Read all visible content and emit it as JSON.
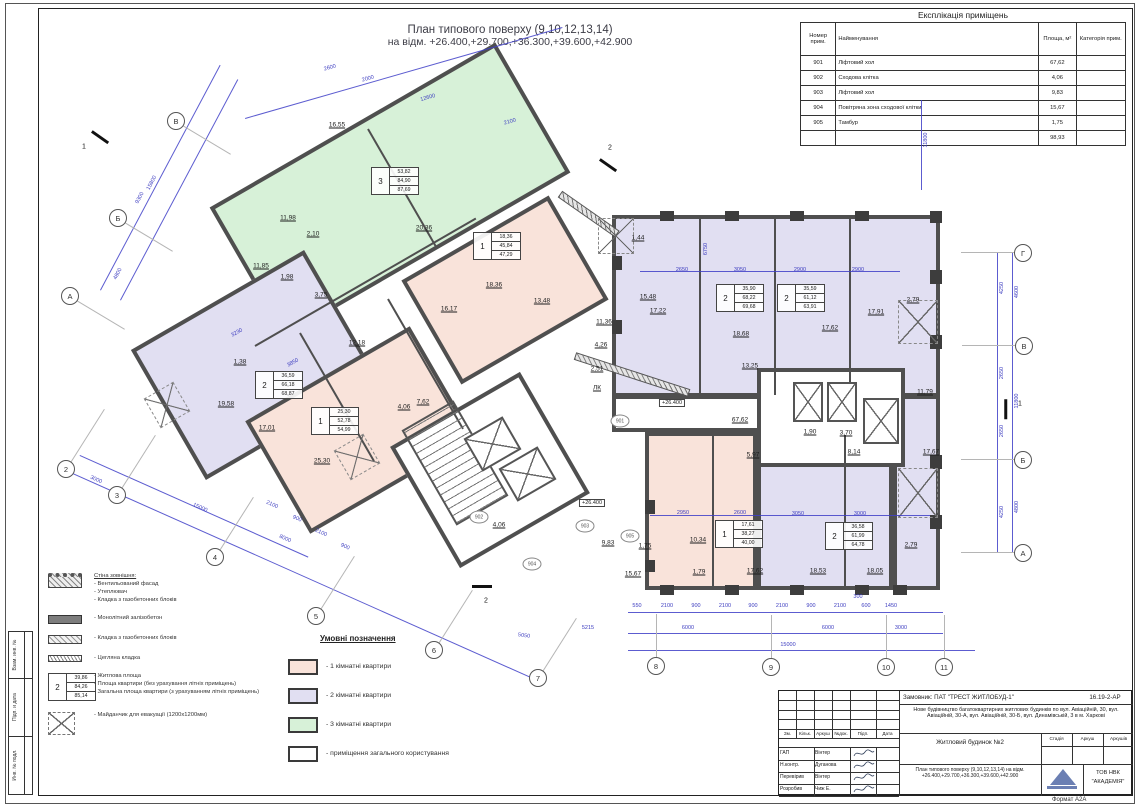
{
  "colors": {
    "one_room": "#f9e3da",
    "two_room": "#e1dff2",
    "three_room": "#d7f1d8",
    "dimension": "#4040c8",
    "wall": "#4f4f4f"
  },
  "sheet": {
    "title_line1": "План типового поверху (9,10,12,13,14)",
    "title_line2": "на відм. +26.400,+29.700,+36.300,+39.600,+42.900",
    "format_label": "Формат А2А"
  },
  "frame_labels": [
    "Взам. инв. №",
    "Підп. и дата",
    "Инв. № подл."
  ],
  "explication": {
    "title": "Експлікація приміщень",
    "headers": [
      "Номер прим.",
      "Найменування",
      "Площа, м²",
      "Категорія прим."
    ],
    "rows": [
      [
        "901",
        "Ліфтовий хол",
        "67,62"
      ],
      [
        "902",
        "Сходова клітка",
        "4,06"
      ],
      [
        "903",
        "Ліфтовий хол",
        "9,83"
      ],
      [
        "904",
        "Повітряна зона сходової клітки",
        "15,67"
      ],
      [
        "905",
        "Тамбур",
        "1,75"
      ]
    ],
    "total": "98,93"
  },
  "wall_legend": {
    "items": [
      {
        "symbol": "wallext",
        "title": "Стіна зовнішня:",
        "lines": [
          "- Вентильований фасад",
          "- Утеплювач",
          "- Кладка з газобетонних блоків"
        ]
      },
      {
        "symbol": "concrete",
        "lines": [
          "- Монолітний залізобетон"
        ]
      },
      {
        "symbol": "blocks",
        "lines": [
          "- Кладка з газобетонних блоків"
        ]
      },
      {
        "symbol": "brick",
        "lines": [
          "- Цегляна кладка"
        ]
      },
      {
        "symbol": "apttag",
        "tag": {
          "num": "2",
          "areas": [
            "39,86",
            "84,26",
            "85,14"
          ]
        },
        "lines": [
          "- Житлова площа",
          "- Площа квартири (без урахування літніх приміщень)",
          "- Загальна площа квартири (з урахуванням літніх приміщень)"
        ]
      },
      {
        "symbol": "evac",
        "lines": [
          "- Майданчик для евакуації (1200х1200мм)"
        ]
      }
    ]
  },
  "color_legend": {
    "title": "Умовні позначення",
    "items": [
      {
        "color": "#f9e3da",
        "label": "- 1 кімнатні квартири"
      },
      {
        "color": "#e1dff2",
        "label": "- 2 кімнатні квартири"
      },
      {
        "color": "#d7f1d8",
        "label": "- 3 кімнатні квартири"
      },
      {
        "color": "#ffffff",
        "label": "- приміщення загального користування"
      }
    ]
  },
  "plan": {
    "blocks": [
      {
        "x": 225,
        "y": 115,
        "w": 330,
        "h": 150,
        "rot": -30,
        "fill": "green"
      },
      {
        "x": 420,
        "y": 230,
        "w": 170,
        "h": 120,
        "rot": -30,
        "fill": "pink"
      },
      {
        "x": 155,
        "y": 290,
        "w": 200,
        "h": 150,
        "rot": -30,
        "fill": "purple"
      },
      {
        "x": 265,
        "y": 365,
        "w": 190,
        "h": 130,
        "rot": -30,
        "fill": "pink"
      },
      {
        "x": 612,
        "y": 215,
        "w": 328,
        "h": 182,
        "rot": 0,
        "fill": "purple"
      },
      {
        "x": 893,
        "y": 395,
        "w": 47,
        "h": 195,
        "rot": 0,
        "fill": "purple"
      },
      {
        "x": 612,
        "y": 395,
        "w": 281,
        "h": 37,
        "rot": 0,
        "fill": "white"
      },
      {
        "x": 645,
        "y": 432,
        "w": 112,
        "h": 158,
        "rot": 0,
        "fill": "pink"
      },
      {
        "x": 757,
        "y": 432,
        "w": 136,
        "h": 158,
        "rot": 0,
        "fill": "purple"
      },
      {
        "x": 415,
        "y": 400,
        "w": 150,
        "h": 140,
        "rot": -30,
        "fill": "white"
      },
      {
        "x": 757,
        "y": 368,
        "w": 148,
        "h": 99,
        "rot": 0,
        "fill": "white"
      }
    ],
    "walls": [
      {
        "x": 368,
        "y": 128,
        "len": 135,
        "rot": 60
      },
      {
        "x": 255,
        "y": 345,
        "len": 255,
        "rot": -30
      },
      {
        "x": 300,
        "y": 332,
        "len": 148,
        "rot": 60
      },
      {
        "x": 388,
        "y": 298,
        "len": 150,
        "rot": 60
      },
      {
        "x": 700,
        "y": 218,
        "len": 176,
        "rot": 90
      },
      {
        "x": 775,
        "y": 218,
        "len": 176,
        "rot": 90
      },
      {
        "x": 850,
        "y": 218,
        "len": 176,
        "rot": 90
      },
      {
        "x": 713,
        "y": 434,
        "len": 154,
        "rot": 90
      },
      {
        "x": 845,
        "y": 434,
        "len": 154,
        "rot": 90
      }
    ],
    "hatch_walls": [
      {
        "x": 560,
        "y": 190,
        "len": 70,
        "rot": 35
      },
      {
        "x": 575,
        "y": 352,
        "len": 120,
        "rot": 18
      }
    ],
    "columns": [
      [
        660,
        211,
        14,
        10
      ],
      [
        725,
        211,
        14,
        10
      ],
      [
        790,
        211,
        14,
        10
      ],
      [
        855,
        211,
        14,
        10
      ],
      [
        930,
        211,
        12,
        12
      ],
      [
        612,
        256,
        10,
        14
      ],
      [
        612,
        320,
        10,
        14
      ],
      [
        930,
        270,
        12,
        14
      ],
      [
        930,
        335,
        12,
        14
      ],
      [
        930,
        455,
        12,
        14
      ],
      [
        930,
        515,
        12,
        14
      ],
      [
        660,
        585,
        14,
        10
      ],
      [
        725,
        585,
        14,
        10
      ],
      [
        790,
        585,
        14,
        10
      ],
      [
        855,
        585,
        14,
        10
      ],
      [
        893,
        585,
        14,
        10
      ],
      [
        645,
        500,
        10,
        14
      ],
      [
        645,
        560,
        10,
        12
      ]
    ],
    "shafts": [
      {
        "x": 470,
        "y": 425,
        "w": 45,
        "h": 38,
        "rot": -30
      },
      {
        "x": 505,
        "y": 455,
        "w": 45,
        "h": 38,
        "rot": -30
      },
      {
        "x": 793,
        "y": 382,
        "w": 30,
        "h": 40,
        "rot": 0
      },
      {
        "x": 827,
        "y": 382,
        "w": 30,
        "h": 40,
        "rot": 0
      },
      {
        "x": 863,
        "y": 398,
        "w": 36,
        "h": 46,
        "rot": 0
      }
    ],
    "stairs": [
      {
        "x": 425,
        "y": 408,
        "w": 60,
        "h": 110,
        "rot": -30
      }
    ],
    "evac_pads": [
      [
        898,
        300,
        40,
        44,
        0
      ],
      [
        898,
        468,
        40,
        50,
        0
      ],
      [
        340,
        440,
        34,
        34,
        -30
      ],
      [
        150,
        388,
        34,
        34,
        -30
      ],
      [
        598,
        218,
        36,
        36,
        0
      ]
    ],
    "dim_lines": [
      [
        628,
        612,
        315,
        0
      ],
      [
        628,
        633,
        315,
        0
      ],
      [
        628,
        650,
        347,
        0
      ],
      [
        998,
        253,
        300,
        90
      ],
      [
        1013,
        253,
        300,
        90
      ],
      [
        66,
        470,
        512,
        24
      ],
      [
        80,
        455,
        250,
        24
      ],
      [
        100,
        290,
        255,
        -62
      ],
      [
        120,
        300,
        250,
        -62
      ],
      [
        245,
        118,
        330,
        -16
      ],
      [
        640,
        271,
        260,
        0
      ],
      [
        650,
        515,
        280,
        0
      ],
      [
        922,
        100,
        90,
        90
      ]
    ],
    "dim_labels": [
      [
        "550",
        637,
        606,
        0
      ],
      [
        "2100",
        667,
        606,
        0
      ],
      [
        "900",
        696,
        606,
        0
      ],
      [
        "2100",
        725,
        606,
        0
      ],
      [
        "900",
        753,
        606,
        0
      ],
      [
        "2100",
        782,
        606,
        0
      ],
      [
        "900",
        811,
        606,
        0
      ],
      [
        "2100",
        840,
        606,
        0
      ],
      [
        "600",
        866,
        606,
        0
      ],
      [
        "1450",
        891,
        606,
        0
      ],
      [
        "300",
        858,
        597,
        0
      ],
      [
        "6000",
        688,
        628,
        0
      ],
      [
        "6000",
        828,
        628,
        0
      ],
      [
        "3000",
        901,
        628,
        0
      ],
      [
        "15000",
        788,
        645,
        0
      ],
      [
        "5215",
        588,
        628,
        0
      ],
      [
        "5050",
        524,
        636,
        8
      ],
      [
        "4250",
        1002,
        288,
        -90
      ],
      [
        "2650",
        1002,
        373,
        -90
      ],
      [
        "2650",
        1002,
        431,
        -90
      ],
      [
        "4250",
        1002,
        512,
        -90
      ],
      [
        "4600",
        1017,
        292,
        -90
      ],
      [
        "11800",
        1017,
        401,
        -90
      ],
      [
        "4800",
        1017,
        507,
        -90
      ],
      [
        "11800",
        926,
        140,
        -90
      ],
      [
        "15800",
        152,
        183,
        -62
      ],
      [
        "9300",
        140,
        198,
        -62
      ],
      [
        "4800",
        118,
        274,
        -62
      ],
      [
        "15000",
        200,
        508,
        24
      ],
      [
        "8000",
        285,
        539,
        24
      ],
      [
        "3000",
        96,
        480,
        24
      ],
      [
        "2100",
        272,
        505,
        24
      ],
      [
        "900",
        297,
        519,
        24
      ],
      [
        "2100",
        321,
        533,
        24
      ],
      [
        "900",
        345,
        547,
        24
      ],
      [
        "2600",
        330,
        68,
        -16
      ],
      [
        "2000",
        368,
        79,
        -16
      ],
      [
        "12600",
        428,
        98,
        -16
      ],
      [
        "2100",
        510,
        122,
        -16
      ],
      [
        "2650",
        682,
        270,
        0
      ],
      [
        "3050",
        740,
        270,
        0
      ],
      [
        "2900",
        800,
        270,
        0
      ],
      [
        "2900",
        858,
        270,
        0
      ],
      [
        "6750",
        706,
        249,
        -90
      ],
      [
        "2950",
        683,
        513,
        0
      ],
      [
        "2600",
        740,
        513,
        0
      ],
      [
        "3050",
        798,
        514,
        0
      ],
      [
        "3000",
        860,
        514,
        0
      ],
      [
        "3230",
        237,
        333,
        -30
      ],
      [
        "3850",
        293,
        363,
        -30
      ]
    ],
    "axes": [
      {
        "label": "В",
        "x": 176,
        "y": 121,
        "dir": "dr"
      },
      {
        "label": "Б",
        "x": 118,
        "y": 218,
        "dir": "dr"
      },
      {
        "label": "А",
        "x": 70,
        "y": 296,
        "dir": "dr"
      },
      {
        "label": "2",
        "x": 66,
        "y": 469,
        "dir": "ur"
      },
      {
        "label": "3",
        "x": 117,
        "y": 495,
        "dir": "ur"
      },
      {
        "label": "4",
        "x": 215,
        "y": 557,
        "dir": "ur"
      },
      {
        "label": "5",
        "x": 316,
        "y": 616,
        "dir": "ur"
      },
      {
        "label": "6",
        "x": 434,
        "y": 650,
        "dir": "ur"
      },
      {
        "label": "7",
        "x": 538,
        "y": 678,
        "dir": "ur"
      },
      {
        "label": "8",
        "x": 656,
        "y": 666,
        "dir": "u"
      },
      {
        "label": "9",
        "x": 771,
        "y": 667,
        "dir": "u"
      },
      {
        "label": "10",
        "x": 886,
        "y": 667,
        "dir": "u"
      },
      {
        "label": "11",
        "x": 944,
        "y": 667,
        "dir": "u"
      },
      {
        "label": "Г",
        "x": 1023,
        "y": 253,
        "dir": "l"
      },
      {
        "label": "В",
        "x": 1024,
        "y": 346,
        "dir": "l"
      },
      {
        "label": "Б",
        "x": 1023,
        "y": 460,
        "dir": "l"
      },
      {
        "label": "А",
        "x": 1023,
        "y": 553,
        "dir": "l"
      }
    ],
    "rooms": [
      [
        "16,55",
        337,
        125
      ],
      [
        "20,36",
        424,
        228
      ],
      [
        "16,17",
        449,
        309
      ],
      [
        "4,06",
        404,
        407
      ],
      [
        "11,98",
        288,
        218
      ],
      [
        "2,10",
        313,
        234
      ],
      [
        "11,85",
        261,
        266
      ],
      [
        "1,98",
        287,
        277
      ],
      [
        "3,75",
        321,
        295
      ],
      [
        "1,38",
        240,
        362
      ],
      [
        "19,58",
        226,
        404
      ],
      [
        "17,01",
        267,
        428
      ],
      [
        "25,30",
        322,
        461
      ],
      [
        "12,18",
        357,
        343
      ],
      [
        "7,62",
        423,
        402
      ],
      [
        "18,36",
        494,
        285
      ],
      [
        "13,48",
        542,
        301
      ],
      [
        "15,48",
        648,
        297
      ],
      [
        "11,36",
        604,
        322
      ],
      [
        "4,26",
        601,
        345
      ],
      [
        "2,51",
        597,
        369
      ],
      [
        "1,44",
        638,
        238
      ],
      [
        "ЛК",
        597,
        388
      ],
      [
        "4,06",
        499,
        525
      ],
      [
        "9,83",
        608,
        543
      ],
      [
        "1,75",
        645,
        546
      ],
      [
        "15,67",
        633,
        574
      ],
      [
        "17,22",
        658,
        311
      ],
      [
        "18,68",
        741,
        334
      ],
      [
        "17,62",
        830,
        328
      ],
      [
        "17,91",
        876,
        312
      ],
      [
        "2,79",
        913,
        300
      ],
      [
        "13,25",
        750,
        366
      ],
      [
        "11,79",
        925,
        392
      ],
      [
        "8,14",
        854,
        452
      ],
      [
        "17,67",
        931,
        452
      ],
      [
        "5,97",
        753,
        455
      ],
      [
        "1,90",
        810,
        432
      ],
      [
        "3,70",
        846,
        433
      ],
      [
        "67,62",
        740,
        420
      ],
      [
        "10,34",
        698,
        540
      ],
      [
        "17,62",
        755,
        571
      ],
      [
        "1,79",
        699,
        572
      ],
      [
        "18,53",
        818,
        571
      ],
      [
        "18,05",
        875,
        571
      ],
      [
        "2,79",
        911,
        545
      ]
    ],
    "room_ids": [
      [
        "901",
        620,
        421
      ],
      [
        "902",
        479,
        517
      ],
      [
        "903",
        585,
        526
      ],
      [
        "904",
        532,
        564
      ],
      [
        "905",
        630,
        536
      ]
    ],
    "tags": [
      {
        "num": "3",
        "areas": [
          "53,82",
          "84,90",
          "87,69"
        ],
        "x": 371,
        "y": 167
      },
      {
        "num": "1",
        "areas": [
          "18,36",
          "45,84",
          "47,29"
        ],
        "x": 473,
        "y": 232
      },
      {
        "num": "2",
        "areas": [
          "36,59",
          "66,18",
          "68,87"
        ],
        "x": 255,
        "y": 371
      },
      {
        "num": "1",
        "areas": [
          "25,30",
          "52,78",
          "54,99"
        ],
        "x": 311,
        "y": 407
      },
      {
        "num": "2",
        "areas": [
          "35,90",
          "68,22",
          "69,68"
        ],
        "x": 716,
        "y": 284
      },
      {
        "num": "2",
        "areas": [
          "35,59",
          "61,12",
          "63,91"
        ],
        "x": 777,
        "y": 284
      },
      {
        "num": "1",
        "areas": [
          "17,61",
          "38,27",
          "40,00"
        ],
        "x": 715,
        "y": 520
      },
      {
        "num": "2",
        "areas": [
          "36,58",
          "61,99",
          "64,78"
        ],
        "x": 825,
        "y": 522
      }
    ],
    "elevations": [
      [
        "+26.400",
        672,
        403
      ],
      [
        "+26.400",
        592,
        503
      ]
    ],
    "section_marks": [
      {
        "x": 92,
        "y": 130,
        "rot": 35,
        "label": "1",
        "lx": 84,
        "ly": 147
      },
      {
        "x": 600,
        "y": 158,
        "rot": 35,
        "label": "2",
        "lx": 610,
        "ly": 148
      },
      {
        "x": 472,
        "y": 585,
        "rot": 0,
        "label": "2",
        "lx": 486,
        "ly": 601
      },
      {
        "x": 1006,
        "y": 398,
        "rot": 90,
        "label": "1",
        "lx": 1020,
        "ly": 404
      }
    ]
  },
  "titleblock": {
    "customer": "Замовник: ПАТ \"ТРЕСТ ЖИТЛОБУД-1\"",
    "doc_number": "16.19-2-АР",
    "description": "Нове будівництво багатоквартирних житлових будинків по вул. Авіаційній, 30, вул. Авіаційній, 30-А, вул. Авіаційній, 30-Б, вул. Динамівській, 3 в м. Харкові",
    "object_name": "Житловий будинок №2",
    "drawing_title": "План типового поверху (9,10,12,13,14) на відм. +26.400,+29.700,+36.300,+39.600,+42.900",
    "company_line1": "ТОВ НВК",
    "company_line2": "\"АКАДЕМІЯ\"",
    "stage_headers": [
      "Стадія",
      "Аркуш",
      "Аркушів"
    ],
    "sig_headers": [
      "Зм.",
      "Кільк.",
      "Аркуш",
      "№док.",
      "Підп.",
      "Дата"
    ],
    "signatures": [
      {
        "role": "ГАП",
        "name": "Вінтер"
      },
      {
        "role": "Н.контр.",
        "name": "Дуганова"
      },
      {
        "role": "Перевірив",
        "name": "Вінтер"
      },
      {
        "role": "Розробив",
        "name": "Чиж Е."
      }
    ]
  }
}
